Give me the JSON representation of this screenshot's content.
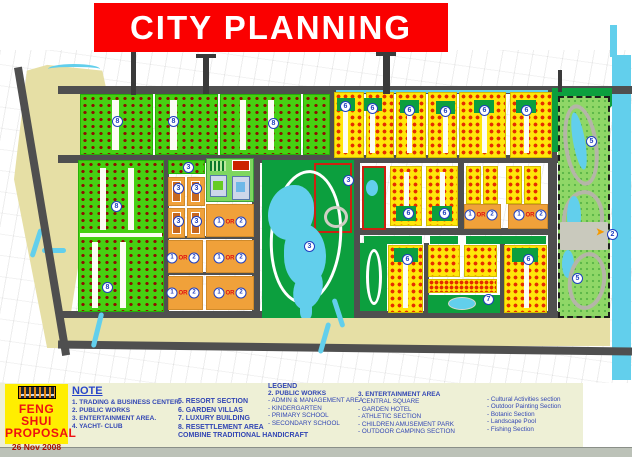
{
  "banner": {
    "title": "CITY PLANNING",
    "bg_color": "#fa0000",
    "text_color": "#ffffff"
  },
  "proposal": {
    "line1": "FENG SHUI",
    "line2": "PROPOSAL",
    "date": "26 Nov 2008",
    "logo": "company-logo"
  },
  "note": {
    "heading": "NOTE",
    "col1": [
      "1. TRADING & BUSINESS CENTER.",
      "2. PUBLIC WORKS",
      "3. ENTERTAINMENT AREA.",
      "4. YACHT- CLUB"
    ],
    "col2": [
      "5. RESORT SECTION",
      "6. GARDEN VILLAS",
      "7. LUXURY BUILDING",
      "8. RESETTLEMENT AREA",
      "COMBINE TRADITIONAL HANDICRAFT"
    ]
  },
  "legend": {
    "heading": "LEGEND",
    "groups": [
      {
        "title": "2. PUBLIC WORKS",
        "items": [
          "- ADMIN & MANAGEMENT AREA",
          "- KINDERGARTEN",
          "- PRIMARY SCHOOL",
          "- SECONDARY SCHOOL"
        ]
      },
      {
        "title": "3. ENTERTAINMENT AREA",
        "items": [
          "- CENTRAL SQUARE",
          "- GARDEN HOTEL",
          "- ATHLETIC SECTION",
          "- CHILDREN AMUSEMENT PARK",
          "- OUTDOOR CAMPING SECTION"
        ]
      },
      {
        "title": "",
        "items": [
          "- Cultural Activities section",
          "- Outdoor Painting Section",
          "- Botanic Section",
          "- Landscape Pool",
          "- Fishing Section"
        ]
      }
    ]
  },
  "map": {
    "markers": [
      {
        "n": "8",
        "x": 117,
        "y": 121
      },
      {
        "n": "8",
        "x": 173,
        "y": 121
      },
      {
        "n": "8",
        "x": 273,
        "y": 123
      },
      {
        "n": "8",
        "x": 116,
        "y": 206
      },
      {
        "n": "8",
        "x": 107,
        "y": 287
      },
      {
        "n": "6",
        "x": 345,
        "y": 106
      },
      {
        "n": "6",
        "x": 372,
        "y": 108
      },
      {
        "n": "6",
        "x": 409,
        "y": 110
      },
      {
        "n": "6",
        "x": 445,
        "y": 111
      },
      {
        "n": "6",
        "x": 484,
        "y": 110
      },
      {
        "n": "6",
        "x": 526,
        "y": 110
      },
      {
        "n": "6",
        "x": 408,
        "y": 213
      },
      {
        "n": "6",
        "x": 444,
        "y": 213
      },
      {
        "n": "6",
        "x": 407,
        "y": 259
      },
      {
        "n": "6",
        "x": 528,
        "y": 259
      },
      {
        "n": "3",
        "x": 188,
        "y": 167
      },
      {
        "n": "3",
        "x": 178,
        "y": 188
      },
      {
        "n": "3",
        "x": 196,
        "y": 188
      },
      {
        "n": "3",
        "x": 178,
        "y": 221
      },
      {
        "n": "3",
        "x": 196,
        "y": 221
      },
      {
        "n": "3",
        "x": 348,
        "y": 180
      },
      {
        "n": "3",
        "x": 309,
        "y": 246
      },
      {
        "n": "7",
        "x": 488,
        "y": 299
      },
      {
        "n": "5",
        "x": 591,
        "y": 141
      },
      {
        "n": "5",
        "x": 577,
        "y": 278
      },
      {
        "n": "2",
        "x": 612,
        "y": 234
      }
    ],
    "or_labels": [
      {
        "a": "1",
        "or": "OR",
        "b": "2",
        "x": 230,
        "y": 222
      },
      {
        "a": "1",
        "or": "OR",
        "b": "2",
        "x": 183,
        "y": 258
      },
      {
        "a": "1",
        "or": "OR",
        "b": "2",
        "x": 230,
        "y": 258
      },
      {
        "a": "1",
        "or": "OR",
        "b": "2",
        "x": 183,
        "y": 293
      },
      {
        "a": "1",
        "or": "OR",
        "b": "2",
        "x": 230,
        "y": 293
      },
      {
        "a": "1",
        "or": "OR",
        "b": "2",
        "x": 481,
        "y": 215
      },
      {
        "a": "1",
        "or": "OR",
        "b": "2",
        "x": 530,
        "y": 215
      }
    ],
    "palette": {
      "residential_green": "#46d012",
      "villa_yellow": "#ffe60a",
      "public_orange": "#f0a13a",
      "park_green": "#0c9f3e",
      "resort_green": "#8fd767",
      "water_cyan": "#62cfec",
      "road_gray": "#4f4f4f",
      "sand_beige": "#e6dfa5"
    }
  }
}
